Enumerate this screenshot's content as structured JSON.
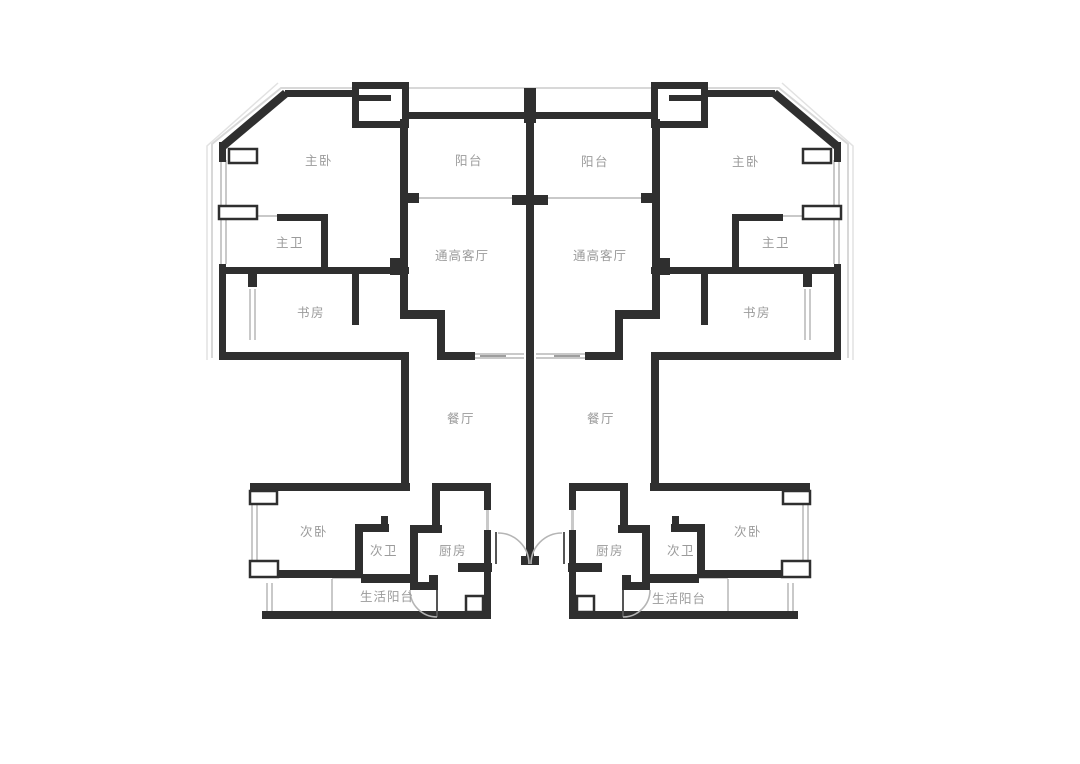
{
  "colors": {
    "background": "#ffffff",
    "wall": "#2f2f2f",
    "window_line": "#c9c9c9",
    "door_arc": "#b5b5b5",
    "outer_line": "#d8d8d8",
    "label_text": "#9b9b9b"
  },
  "plan": {
    "kind": "floor-plan, two mirrored apartment units",
    "units": {
      "left": {
        "rooms": [
          {
            "name": "主卧"
          },
          {
            "name": "阳台"
          },
          {
            "name": "主卫"
          },
          {
            "name": "通高客厅"
          },
          {
            "name": "书房"
          },
          {
            "name": "餐厅"
          },
          {
            "name": "次卧"
          },
          {
            "name": "次卫"
          },
          {
            "name": "厨房"
          },
          {
            "name": "生活阳台"
          }
        ]
      },
      "right": {
        "rooms": [
          {
            "name": "阳台"
          },
          {
            "name": "主卧"
          },
          {
            "name": "主卫"
          },
          {
            "name": "通高客厅"
          },
          {
            "name": "书房"
          },
          {
            "name": "餐厅"
          },
          {
            "name": "厨房"
          },
          {
            "name": "次卫"
          },
          {
            "name": "次卧"
          },
          {
            "name": "生活阳台"
          }
        ]
      }
    }
  }
}
